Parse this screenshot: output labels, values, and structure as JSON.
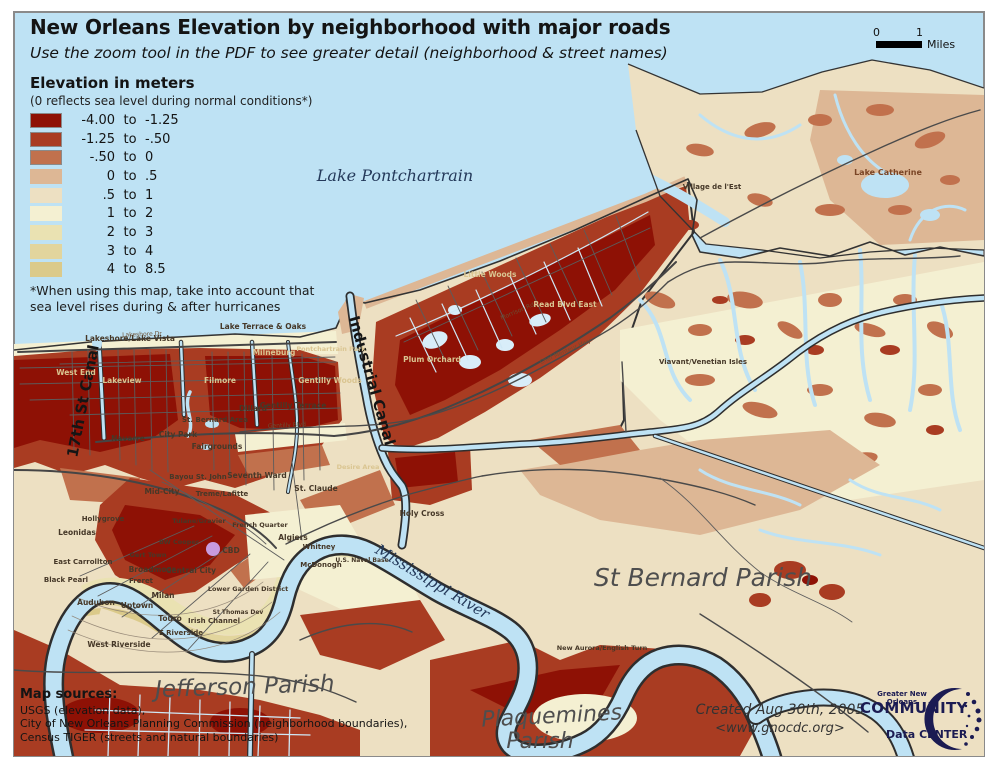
{
  "header": {
    "title": "New Orleans Elevation by neighborhood with major roads",
    "subtitle": "Use the zoom tool in the PDF to see greater detail (neighborhood & street names)"
  },
  "scale_bar": {
    "tick0": "0",
    "tick1": "1",
    "unit": "Miles"
  },
  "legend": {
    "title": "Elevation in meters",
    "subtitle": "(0 reflects sea level during normal conditions*)",
    "entries": [
      {
        "from": "-4.00",
        "word": "to",
        "to": "-1.25",
        "color": "#8E1105",
        "outlined": true
      },
      {
        "from": "-1.25",
        "word": "to",
        "to": "-.50",
        "color": "#A93C22",
        "outlined": true
      },
      {
        "from": "-.50",
        "word": "to",
        "to": "0",
        "color": "#C1714D",
        "outlined": true
      },
      {
        "from": "0",
        "word": "to",
        "to": ".5",
        "color": "#DDB795",
        "outlined": false
      },
      {
        "from": ".5",
        "word": "to",
        "to": "1",
        "color": "#EDE0C2",
        "outlined": false
      },
      {
        "from": "1",
        "word": "to",
        "to": "2",
        "color": "#F4F0D2",
        "outlined": false
      },
      {
        "from": "2",
        "word": "to",
        "to": "3",
        "color": "#EAE2B2",
        "outlined": false
      },
      {
        "from": "3",
        "word": "to",
        "to": "4",
        "color": "#E2D59D",
        "outlined": false
      },
      {
        "from": "4",
        "word": "to",
        "to": "8.5",
        "color": "#DBCA8A",
        "outlined": false
      }
    ],
    "footnote_line1": "*When using this map, take into account that",
    "footnote_line2": "sea level rises during & after hurricanes"
  },
  "sources": {
    "heading": "Map sources:",
    "lines": [
      "USGS (elevation data),",
      "City of New Orleans Planning Commission (neighborhood boundaries),",
      "Census TIGER (streets and natural boundaries)"
    ]
  },
  "credits": {
    "created": "Created Aug 30th, 2005",
    "url": "<www.gnocdc.org>"
  },
  "logo": {
    "line1": "Greater New Orleans",
    "line2": "COMMUNITY",
    "line3": "Data CENTER"
  },
  "map": {
    "water_color": "#BEE2F4",
    "border_color": "#8a8a8a",
    "superdome_color": "#C79BDE",
    "labels": [
      {
        "t": "Lake Pontchartrain",
        "x": 395,
        "y": 181,
        "s": 16,
        "c": "water"
      },
      {
        "t": "Mississippi River",
        "x": 430,
        "y": 586,
        "s": 15,
        "c": "water",
        "r": 31
      },
      {
        "t": "17th St Canal",
        "x": 88,
        "y": 402,
        "s": 15,
        "c": "canal",
        "r": -79
      },
      {
        "t": "Industrial Canal",
        "x": 367,
        "y": 382,
        "s": 15,
        "c": "canal",
        "r": 74
      },
      {
        "t": "Jefferson Parish",
        "x": 245,
        "y": 694,
        "s": 23,
        "c": "parish",
        "r": -2
      },
      {
        "t": "St Bernard Parish",
        "x": 703,
        "y": 586,
        "s": 25,
        "c": "parish"
      },
      {
        "t": "Plaquemines",
        "x": 552,
        "y": 723,
        "s": 22,
        "c": "parish",
        "r": -3
      },
      {
        "t": "Parish",
        "x": 540,
        "y": 748,
        "s": 22,
        "c": "parish"
      },
      {
        "t": "Lake Catherine",
        "x": 888,
        "y": 175,
        "s": 8,
        "c": "nbrown"
      },
      {
        "t": "Lakeshore/Lake Vista",
        "x": 130,
        "y": 341,
        "s": 7.5,
        "c": "ndark"
      },
      {
        "t": "Lake Terrace & Oaks",
        "x": 263,
        "y": 329,
        "s": 7.5,
        "c": "ndark"
      },
      {
        "t": "West End",
        "x": 76,
        "y": 375,
        "s": 7.5,
        "c": "nlight"
      },
      {
        "t": "Lakeview",
        "x": 122,
        "y": 383,
        "s": 7.5,
        "c": "nlight"
      },
      {
        "t": "Filmore",
        "x": 220,
        "y": 383,
        "s": 7.5,
        "c": "nlight"
      },
      {
        "t": "Milneburg",
        "x": 274,
        "y": 355,
        "s": 7.5,
        "c": "nlight"
      },
      {
        "t": "Pontchartrain Park",
        "x": 331,
        "y": 351,
        "s": 6.5,
        "c": "nlight"
      },
      {
        "t": "Gentilly Woods",
        "x": 330,
        "y": 383,
        "s": 7.5,
        "c": "nlight"
      },
      {
        "t": "Gentilly Terrace",
        "x": 293,
        "y": 408,
        "s": 7.5,
        "c": "ndark"
      },
      {
        "t": "Dillard",
        "x": 253,
        "y": 411,
        "s": 7.5,
        "c": "ndark"
      },
      {
        "t": "St. Bernard Area",
        "x": 215,
        "y": 422,
        "s": 7,
        "c": "ndark"
      },
      {
        "t": "City Park",
        "x": 178,
        "y": 437,
        "s": 7.5,
        "c": "ndark"
      },
      {
        "t": "Navarre",
        "x": 128,
        "y": 441,
        "s": 7.5,
        "c": "ndark"
      },
      {
        "t": "Fairgrounds",
        "x": 217,
        "y": 449,
        "s": 7.5,
        "c": "ndark"
      },
      {
        "t": "Bayou St. John",
        "x": 198,
        "y": 479,
        "s": 7,
        "c": "ndark"
      },
      {
        "t": "Seventh Ward",
        "x": 257,
        "y": 478,
        "s": 7.5,
        "c": "ndark"
      },
      {
        "t": "Mid-City",
        "x": 162,
        "y": 494,
        "s": 7.5,
        "c": "ndark"
      },
      {
        "t": "Treme/Lafitte",
        "x": 222,
        "y": 496,
        "s": 7,
        "c": "ndark"
      },
      {
        "t": "St. Claude",
        "x": 316,
        "y": 491,
        "s": 7.5,
        "c": "ndark"
      },
      {
        "t": "Holy Cross",
        "x": 422,
        "y": 516,
        "s": 7.5,
        "c": "ndark"
      },
      {
        "t": "Desire Area",
        "x": 358,
        "y": 469,
        "s": 6.5,
        "c": "nlight"
      },
      {
        "t": "Leonidas",
        "x": 77,
        "y": 535,
        "s": 7.5,
        "c": "ndark"
      },
      {
        "t": "East Carrollton",
        "x": 83,
        "y": 564,
        "s": 7,
        "c": "ndark"
      },
      {
        "t": "Black Pearl",
        "x": 66,
        "y": 582,
        "s": 7,
        "c": "ndark"
      },
      {
        "t": "Audubon",
        "x": 96,
        "y": 605,
        "s": 7.5,
        "c": "ndark"
      },
      {
        "t": "Uptown",
        "x": 137,
        "y": 608,
        "s": 7.5,
        "c": "ndark"
      },
      {
        "t": "Touro",
        "x": 170,
        "y": 621,
        "s": 7.5,
        "c": "ndark"
      },
      {
        "t": "E Riverside",
        "x": 181,
        "y": 635,
        "s": 7,
        "c": "ndark"
      },
      {
        "t": "West Riverside",
        "x": 119,
        "y": 647,
        "s": 7.5,
        "c": "ndark"
      },
      {
        "t": "Broadmoor",
        "x": 152,
        "y": 572,
        "s": 7.5,
        "c": "ndark"
      },
      {
        "t": "Freret",
        "x": 141,
        "y": 583,
        "s": 7,
        "c": "ndark"
      },
      {
        "t": "Milan",
        "x": 163,
        "y": 598,
        "s": 7.5,
        "c": "ndark"
      },
      {
        "t": "Central City",
        "x": 191,
        "y": 573,
        "s": 7.5,
        "c": "ndark"
      },
      {
        "t": "Lower Garden District",
        "x": 248,
        "y": 591,
        "s": 6.5,
        "c": "ndark"
      },
      {
        "t": "Irish Channel",
        "x": 214,
        "y": 623,
        "s": 7,
        "c": "ndark"
      },
      {
        "t": "St Thomas Dev",
        "x": 238,
        "y": 614,
        "s": 6,
        "c": "ndark"
      },
      {
        "t": "CBD",
        "x": 231,
        "y": 553,
        "s": 7.5,
        "c": "ndark"
      },
      {
        "t": "French Quarter",
        "x": 260,
        "y": 527,
        "s": 6.5,
        "c": "ndark"
      },
      {
        "t": "Tulane/Gravier",
        "x": 199,
        "y": 523,
        "s": 6.5,
        "c": "ndark"
      },
      {
        "t": "BW Cooper",
        "x": 179,
        "y": 544,
        "s": 6.5,
        "c": "ndark"
      },
      {
        "t": "Gert Town",
        "x": 148,
        "y": 557,
        "s": 6.5,
        "c": "ndark"
      },
      {
        "t": "Hollygrove",
        "x": 103,
        "y": 521,
        "s": 7,
        "c": "ndark"
      },
      {
        "t": "Little Woods",
        "x": 490,
        "y": 277,
        "s": 7.5,
        "c": "nlight"
      },
      {
        "t": "Read Blvd East",
        "x": 565,
        "y": 307,
        "s": 7.5,
        "c": "nlight"
      },
      {
        "t": "Plum Orchard",
        "x": 432,
        "y": 362,
        "s": 7.5,
        "c": "nlight"
      },
      {
        "t": "Village de l'Est",
        "x": 712,
        "y": 189,
        "s": 7,
        "c": "ndark"
      },
      {
        "t": "Viavant/Venetian Isles",
        "x": 703,
        "y": 364,
        "s": 7,
        "c": "ndark"
      },
      {
        "t": "Algiers",
        "x": 293,
        "y": 540,
        "s": 7.5,
        "c": "ndark"
      },
      {
        "t": "Whitney",
        "x": 319,
        "y": 549,
        "s": 7,
        "c": "ndark"
      },
      {
        "t": "U.S. Naval Base",
        "x": 362,
        "y": 562,
        "s": 6,
        "c": "ndark"
      },
      {
        "t": "McDonogh",
        "x": 321,
        "y": 567,
        "s": 7,
        "c": "ndark"
      },
      {
        "t": "New Aurora/English Turn",
        "x": 602,
        "y": 650,
        "s": 6.5,
        "c": "ndark"
      },
      {
        "t": "Lakeshore Dr",
        "x": 142,
        "y": 336,
        "s": 6,
        "c": "street",
        "r": -2
      },
      {
        "t": "Gentilly Blvd",
        "x": 287,
        "y": 427,
        "s": 6,
        "c": "street",
        "r": -3
      },
      {
        "t": "Chef Menteur Hwy",
        "x": 566,
        "y": 353,
        "s": 6,
        "c": "street",
        "r": -24
      },
      {
        "t": "Morrison Rd",
        "x": 518,
        "y": 313,
        "s": 6,
        "c": "street",
        "r": -23
      }
    ]
  }
}
